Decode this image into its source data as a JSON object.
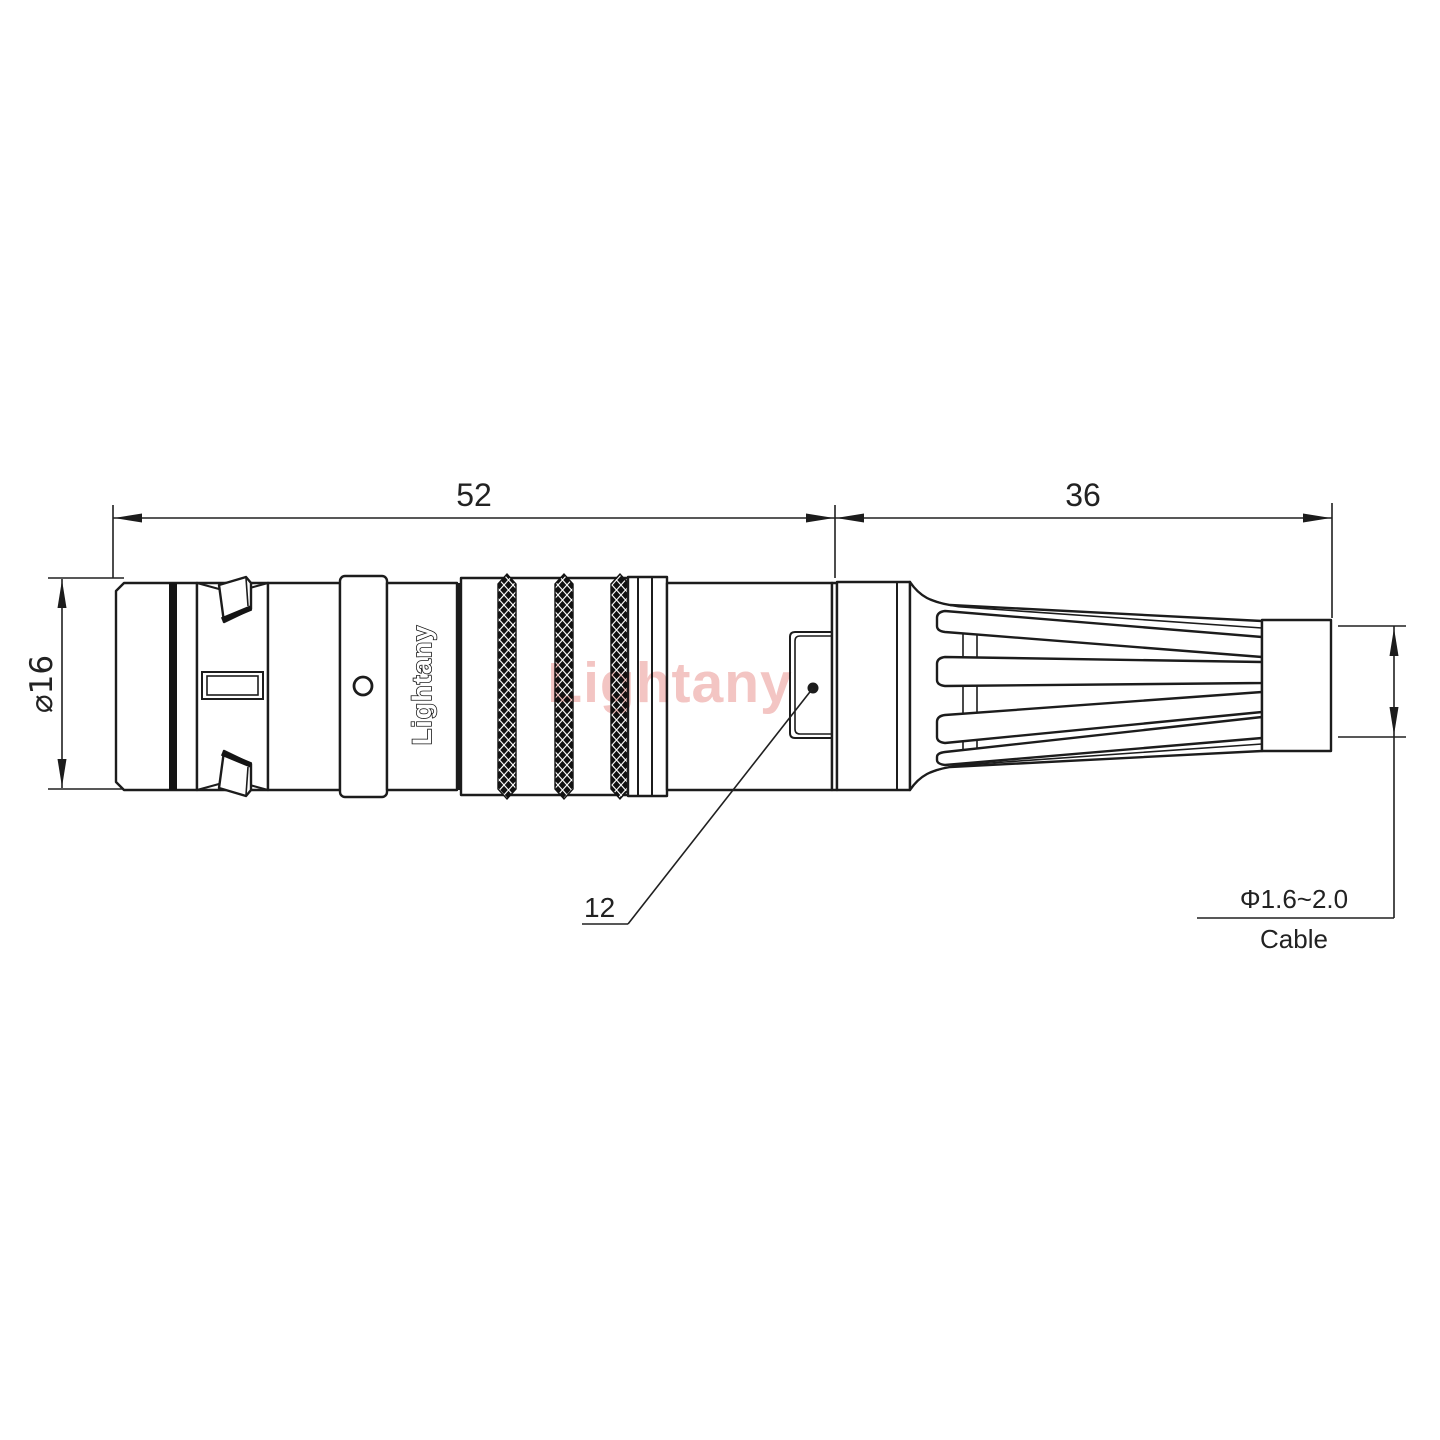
{
  "drawing": {
    "dimensions": {
      "overall_length": "52",
      "boot_length": "36",
      "body_diameter": "⌀16",
      "window_size": "12",
      "cable_range": "Φ1.6~2.0",
      "cable_label": "Cable"
    },
    "branding": {
      "engraving": "Lightany",
      "watermark": "Lightany"
    },
    "colors": {
      "line": "#1c1c1c",
      "watermark": "#f3c5c3",
      "background": "#ffffff"
    }
  }
}
